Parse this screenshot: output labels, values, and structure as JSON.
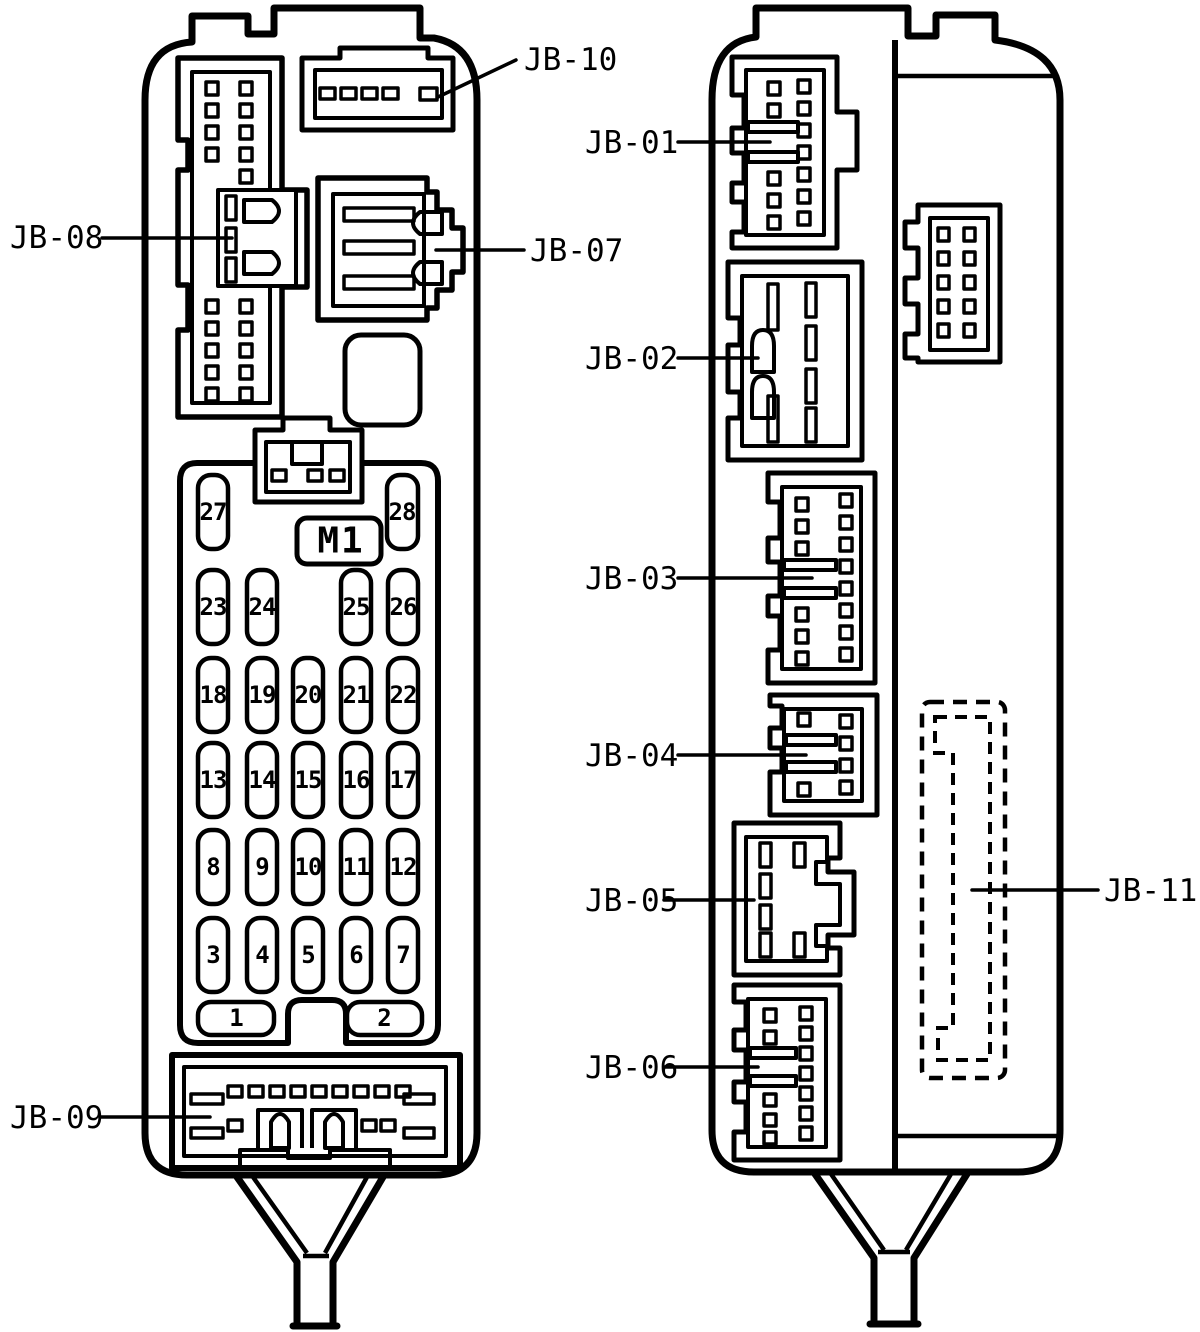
{
  "diagram": {
    "background_color": "#ffffff",
    "line_color": "#000000",
    "description": "Junction block / fuse box, front and side views"
  },
  "left_unit": {
    "labels": {
      "jb07": "JB-07",
      "jb08": "JB-08",
      "jb09": "JB-09",
      "jb10": "JB-10"
    },
    "relay": {
      "label": "M1"
    },
    "fuses": {
      "f1": "1",
      "f2": "2",
      "f3": "3",
      "f4": "4",
      "f5": "5",
      "f6": "6",
      "f7": "7",
      "f8": "8",
      "f9": "9",
      "f10": "10",
      "f11": "11",
      "f12": "12",
      "f13": "13",
      "f14": "14",
      "f15": "15",
      "f16": "16",
      "f17": "17",
      "f18": "18",
      "f19": "19",
      "f20": "20",
      "f21": "21",
      "f22": "22",
      "f23": "23",
      "f24": "24",
      "f25": "25",
      "f26": "26",
      "f27": "27",
      "f28": "28"
    }
  },
  "right_unit": {
    "labels": {
      "jb01": "JB-01",
      "jb02": "JB-02",
      "jb03": "JB-03",
      "jb04": "JB-04",
      "jb05": "JB-05",
      "jb06": "JB-06",
      "jb11": "JB-11"
    }
  }
}
